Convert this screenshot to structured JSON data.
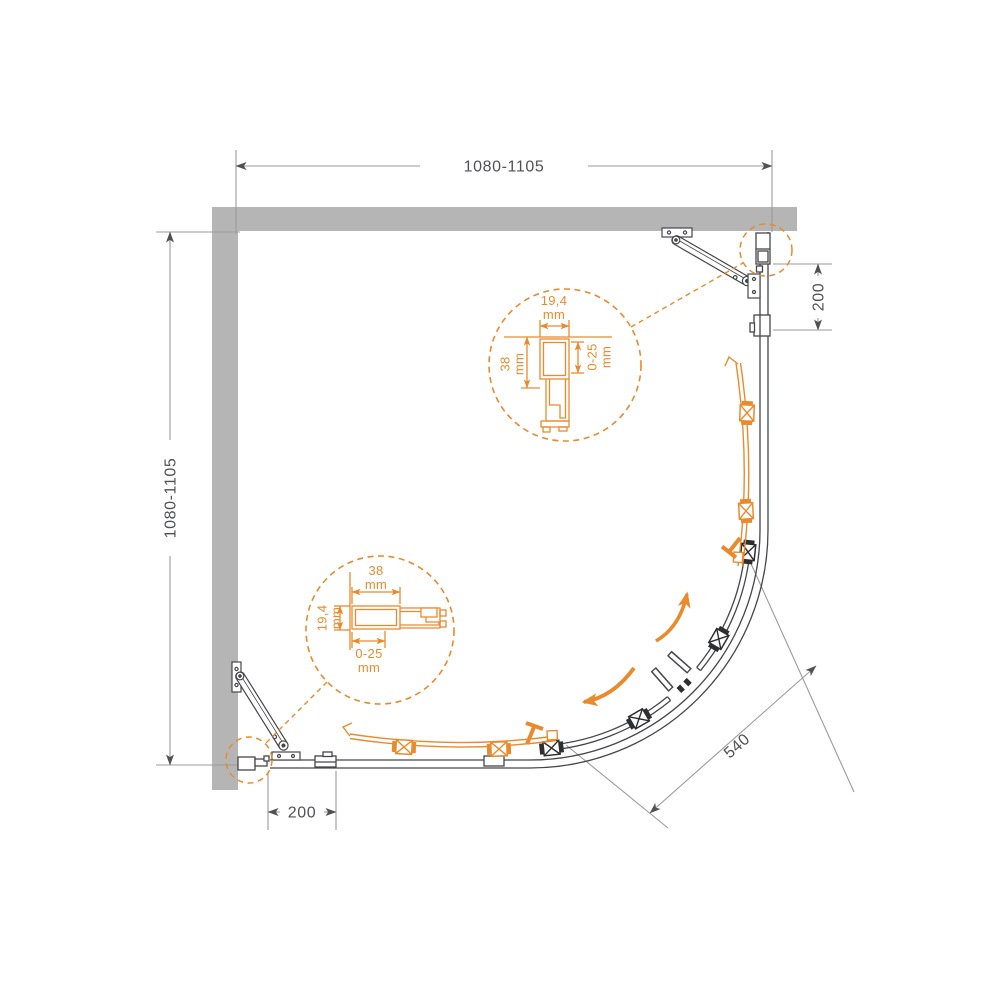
{
  "title": "Corner quadrant shower enclosure — plan view installation diagram",
  "colors": {
    "accent_orange": "#E98B2D",
    "drawing_line": "#45464A",
    "dimension_line": "#9B9B9B",
    "wall_gray": "#B5B5B6",
    "text_dark": "#4F5154"
  },
  "dims": {
    "top_width": "1080-1105",
    "left_depth": "1080-1105",
    "right_panel": "200",
    "bottom_panel": "200",
    "door_width": "540"
  },
  "detail_upper": {
    "width": {
      "value": "19,4",
      "unit": "mm"
    },
    "depth": {
      "value": "38",
      "unit": "mm"
    },
    "gap": {
      "value": "0-25",
      "unit": "mm"
    }
  },
  "detail_lower": {
    "width": {
      "value": "38",
      "unit": "mm"
    },
    "depth": {
      "value": "19,4",
      "unit": "mm"
    },
    "gap": {
      "value": "0-25",
      "unit": "mm"
    }
  }
}
